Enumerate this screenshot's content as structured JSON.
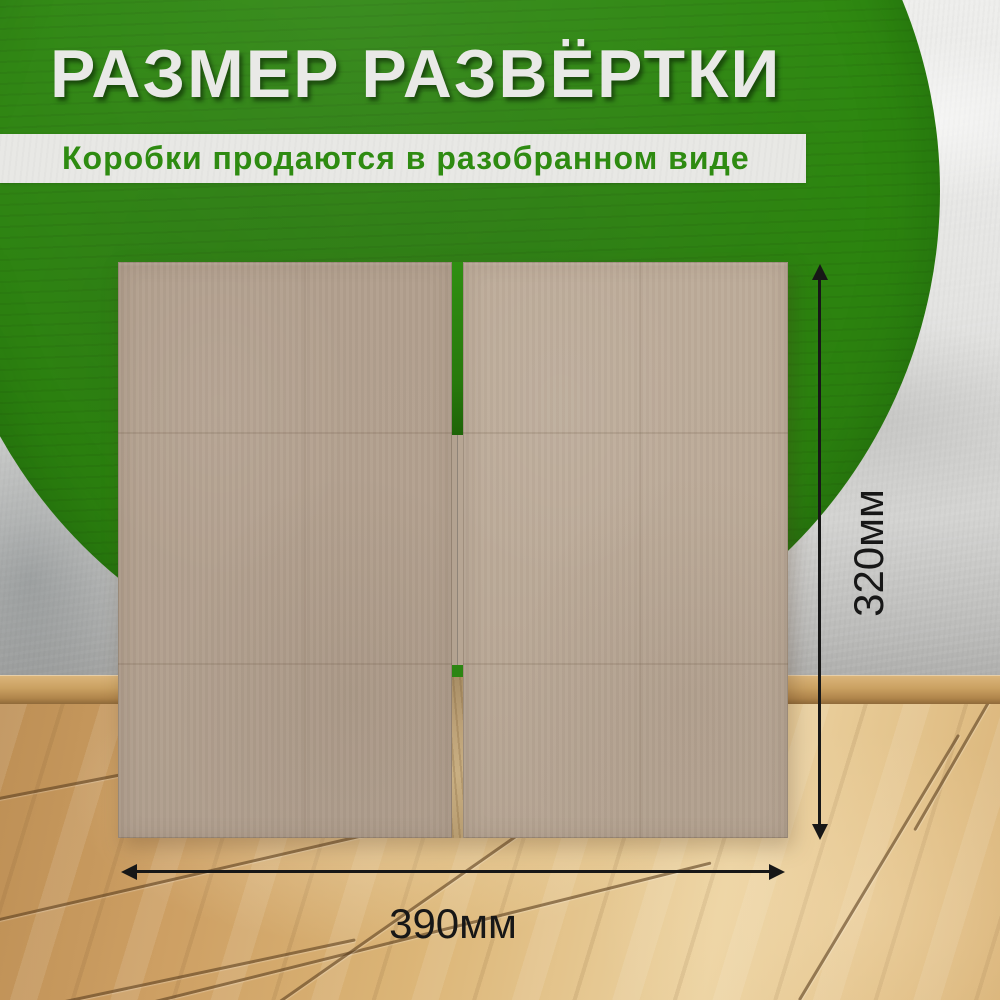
{
  "header": {
    "title": "РАЗМЕР РАЗВЁРТКИ",
    "subtitle": "Коробки продаются в разобранном виде"
  },
  "dimensions": {
    "height_label": "320мм",
    "width_label": "390мм"
  },
  "colors": {
    "green": "#2e8a10",
    "subtitle_green": "#2e8b11",
    "title_color": "#e9e9e7",
    "strip_bg": "#e8e8e5",
    "dimension_color": "#171717",
    "cardboard_left": "#b3a18f",
    "cardboard_right": "#bcab99",
    "wall_light": "#eeeeec",
    "wall_dark": "#a8a8a6",
    "baseboard": "#c79f63",
    "floor_base": "#d9b378",
    "floor_seam": "#5c3f20"
  }
}
